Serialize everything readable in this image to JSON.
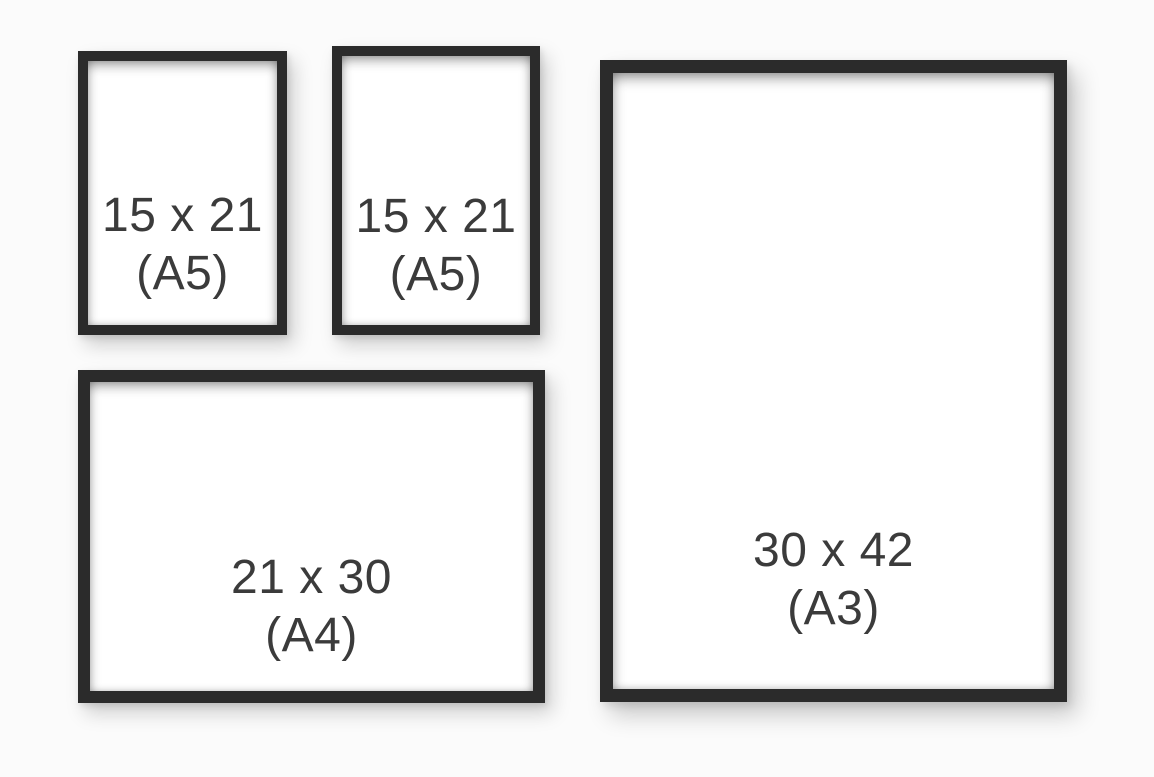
{
  "colors": {
    "background": "#fbfbfb",
    "frame": "#2b2b2b",
    "text": "#3b3b3b",
    "mat": "#ffffff"
  },
  "frames": [
    {
      "name": "a5-top-left",
      "size": "15 x 21",
      "format": "(A5)",
      "orientation": "portrait"
    },
    {
      "name": "a5-top-middle",
      "size": "15 x 21",
      "format": "(A5)",
      "orientation": "portrait"
    },
    {
      "name": "a4-bottom-left",
      "size": "21 x 30",
      "format": "(A4)",
      "orientation": "landscape"
    },
    {
      "name": "a3-right",
      "size": "30 x 42",
      "format": "(A3)",
      "orientation": "portrait"
    }
  ]
}
